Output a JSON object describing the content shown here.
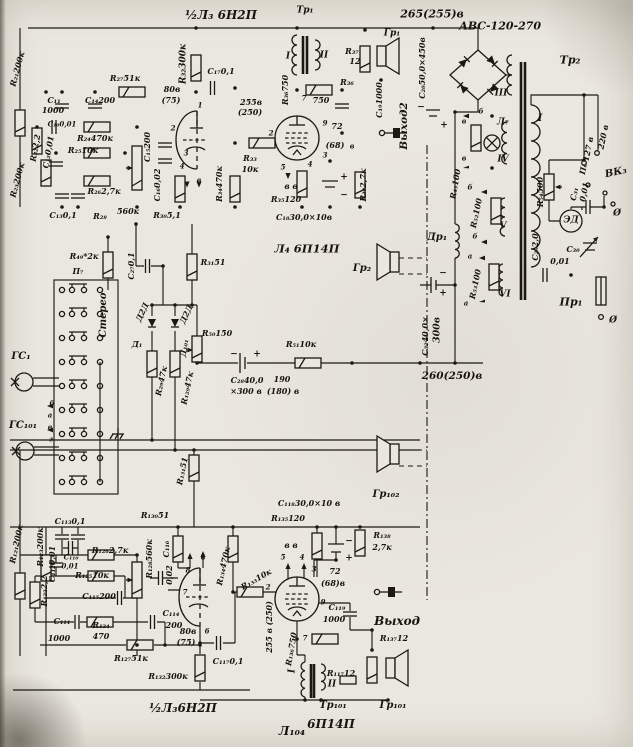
{
  "meta": {
    "description_text": "",
    "ink_color": "#1c1914",
    "paper_color": "#eae7df"
  },
  "labels": [
    {
      "n": "tube-l3-top-title",
      "t": "½Л₃ 6Н2П",
      "x": 221,
      "y": 15,
      "s": 12
    },
    {
      "n": "tr1-title",
      "t": "Тр₁",
      "x": 305,
      "y": 11,
      "s": 9
    },
    {
      "n": "rail-265v",
      "t": "265(255)в",
      "x": 432,
      "y": 14,
      "s": 11
    },
    {
      "n": "rectifier-type",
      "t": "АВС-120-270",
      "x": 500,
      "y": 26,
      "s": 11
    },
    {
      "n": "tr2-title",
      "t": "Тр₂",
      "x": 570,
      "y": 60,
      "s": 11
    },
    {
      "n": "gr1-label",
      "t": "Гр₁",
      "x": 392,
      "y": 34,
      "s": 9
    },
    {
      "n": "r37-label",
      "t": "R₃₇",
      "x": 352,
      "y": 51
    },
    {
      "n": "r37-value",
      "t": "12",
      "x": 355,
      "y": 61
    },
    {
      "n": "r36-label",
      "t": "R₃₆",
      "x": 347,
      "y": 82
    },
    {
      "n": "r36-value",
      "t": "750",
      "x": 321,
      "y": 100
    },
    {
      "n": "r36-rot",
      "t": "R₃₆750",
      "x": 285,
      "y": 90,
      "r": -90
    },
    {
      "n": "tr1-w1",
      "t": "I",
      "x": 288,
      "y": 57,
      "s": 9
    },
    {
      "n": "tr1-w2",
      "t": "II",
      "x": 324,
      "y": 56,
      "s": 9
    },
    {
      "n": "c19-label",
      "t": "C₁₉1000",
      "x": 379,
      "y": 100,
      "r": -90
    },
    {
      "n": "out2-label",
      "t": "Выход2",
      "x": 404,
      "y": 126,
      "r": -90,
      "s": 10.5
    },
    {
      "n": "c20-label",
      "t": "C₂₀50,0×450в",
      "x": 422,
      "y": 68,
      "r": -90
    },
    {
      "n": "c20-plus",
      "t": "+",
      "x": 444,
      "y": 126,
      "s": 9
    },
    {
      "n": "c20-minus",
      "t": "−",
      "x": 421,
      "y": 108,
      "s": 9
    },
    {
      "n": "v72-top",
      "t": "72",
      "x": 337,
      "y": 126
    },
    {
      "n": "v68-top",
      "t": "(68)",
      "x": 335,
      "y": 145
    },
    {
      "n": "v-b-top",
      "t": "в",
      "x": 352,
      "y": 146,
      "s": 7
    },
    {
      "n": "pin9-top",
      "t": "9",
      "x": 325,
      "y": 123,
      "s": 7
    },
    {
      "n": "r38-label",
      "t": "R₃₈2,7к",
      "x": 363,
      "y": 185,
      "r": -90
    },
    {
      "n": "r32-label",
      "t": "R₃₂300к",
      "x": 184,
      "y": 64,
      "r": -90,
      "s": 9
    },
    {
      "n": "c17-label",
      "t": "C₁₇0,1",
      "x": 221,
      "y": 71
    },
    {
      "n": "v80-top",
      "t": "80в",
      "x": 172,
      "y": 89
    },
    {
      "n": "v75-top",
      "t": "(75)",
      "x": 171,
      "y": 100
    },
    {
      "n": "v255-top",
      "t": "255в",
      "x": 251,
      "y": 102
    },
    {
      "n": "v250-top",
      "t": "(250)",
      "x": 250,
      "y": 112
    },
    {
      "n": "r33-label",
      "t": "R₃₃",
      "x": 250,
      "y": 158
    },
    {
      "n": "r33-value",
      "t": "10к",
      "x": 250,
      "y": 169
    },
    {
      "n": "r34-label",
      "t": "R₃₄470к",
      "x": 219,
      "y": 184,
      "r": -90
    },
    {
      "n": "pin7-l4",
      "t": "7",
      "x": 304,
      "y": 98,
      "s": 7
    },
    {
      "n": "pin2-l4",
      "t": "2",
      "x": 271,
      "y": 133,
      "s": 7
    },
    {
      "n": "pin5-l4",
      "t": "5",
      "x": 283,
      "y": 167,
      "s": 7
    },
    {
      "n": "pin4-l4",
      "t": "4",
      "x": 310,
      "y": 164,
      "s": 7
    },
    {
      "n": "pin3-l4",
      "t": "3",
      "x": 325,
      "y": 155,
      "s": 7
    },
    {
      "n": "vv-top",
      "t": "в в",
      "x": 291,
      "y": 186,
      "s": 8
    },
    {
      "n": "r35-label",
      "t": "R₃₅120",
      "x": 286,
      "y": 199
    },
    {
      "n": "c18-label",
      "t": "C₁₈30,0×10в",
      "x": 304,
      "y": 217
    },
    {
      "n": "c18-plus",
      "t": "+",
      "x": 344,
      "y": 178,
      "s": 9
    },
    {
      "n": "c18-minus",
      "t": "−",
      "x": 344,
      "y": 196,
      "s": 9
    },
    {
      "n": "l4-title",
      "t": "Л₄ 6П14П",
      "x": 307,
      "y": 249,
      "s": 11.5
    },
    {
      "n": "pin1-l3",
      "t": "1",
      "x": 200,
      "y": 105,
      "s": 7
    },
    {
      "n": "pin2-l3",
      "t": "2",
      "x": 173,
      "y": 128,
      "s": 7
    },
    {
      "n": "pin3-l3",
      "t": "3",
      "x": 186,
      "y": 153,
      "s": 7
    },
    {
      "n": "pin4-l3",
      "t": "4",
      "x": 182,
      "y": 166,
      "s": 7
    },
    {
      "n": "pinv-l3",
      "t": "в",
      "x": 199,
      "y": 180,
      "s": 7
    },
    {
      "n": "r27-label",
      "t": "R₂₇51к",
      "x": 125,
      "y": 78
    },
    {
      "n": "r21-label",
      "t": "R₂₁200к",
      "x": 17,
      "y": 69,
      "r": -75
    },
    {
      "n": "c11-label",
      "t": "C₁₁",
      "x": 54,
      "y": 100
    },
    {
      "n": "c11-value",
      "t": "1000",
      "x": 53,
      "y": 110
    },
    {
      "n": "c14-label",
      "t": "C₁₄200",
      "x": 100,
      "y": 100
    },
    {
      "n": "c10-label",
      "t": "C₁₀0,01",
      "x": 62,
      "y": 124,
      "s": 7
    },
    {
      "n": "r24-label",
      "t": "R₂₄470к",
      "x": 95,
      "y": 138
    },
    {
      "n": "r25-label",
      "t": "R₂₅10к",
      "x": 83,
      "y": 150
    },
    {
      "n": "r22-label",
      "t": "R₂₂2,2",
      "x": 35,
      "y": 148,
      "r": -80
    },
    {
      "n": "c12-label",
      "t": "C₁₂0,01",
      "x": 48,
      "y": 152,
      "r": -80
    },
    {
      "n": "r26-label",
      "t": "R₂₆2,7к",
      "x": 104,
      "y": 191
    },
    {
      "n": "r23-label",
      "t": "R₂₃200к",
      "x": 17,
      "y": 180,
      "r": -75
    },
    {
      "n": "c13-label",
      "t": "C₁₃0,1",
      "x": 63,
      "y": 215
    },
    {
      "n": "r28-label",
      "t": "R₂₈",
      "x": 100,
      "y": 216
    },
    {
      "n": "r28-value",
      "t": "560к",
      "x": 128,
      "y": 211
    },
    {
      "n": "r30-label",
      "t": "R₃₀5,1",
      "x": 167,
      "y": 215
    },
    {
      "n": "c15-label",
      "t": "C₁₅200",
      "x": 147,
      "y": 147,
      "r": -90
    },
    {
      "n": "c16-label",
      "t": "C₁₆0,02",
      "x": 157,
      "y": 185,
      "r": -90
    },
    {
      "n": "r49-label",
      "t": "R₄₉*2к",
      "x": 84,
      "y": 256
    },
    {
      "n": "p7-label",
      "t": "П₇",
      "x": 78,
      "y": 271
    },
    {
      "n": "stereo-label",
      "t": "Стерео",
      "x": 104,
      "y": 315,
      "r": -90,
      "s": 10
    },
    {
      "n": "c27-label",
      "t": "C₂₇0,1",
      "x": 131,
      "y": 266,
      "r": -90
    },
    {
      "n": "d2d-1",
      "t": "Д2Д",
      "x": 142,
      "y": 312,
      "r": -65
    },
    {
      "n": "d1-label",
      "t": "Д₁",
      "x": 137,
      "y": 344
    },
    {
      "n": "d2d-2",
      "t": "Д2Д",
      "x": 186,
      "y": 314,
      "r": -65
    },
    {
      "n": "d101-label",
      "t": "Д₁₀₁",
      "x": 184,
      "y": 348,
      "r": -80
    },
    {
      "n": "r31-label",
      "t": "R₃₁51",
      "x": 213,
      "y": 262
    },
    {
      "n": "r29-label",
      "t": "R₂₉47к",
      "x": 161,
      "y": 381,
      "r": -78
    },
    {
      "n": "r129-label",
      "t": "R₁₂₉47к",
      "x": 187,
      "y": 388,
      "r": -78
    },
    {
      "n": "r50-label",
      "t": "R₅₀150",
      "x": 217,
      "y": 333
    },
    {
      "n": "c28-label",
      "t": "C₂₈40,0",
      "x": 247,
      "y": 380
    },
    {
      "n": "c28-value",
      "t": "×300 в",
      "x": 246,
      "y": 391
    },
    {
      "n": "c28-minus",
      "t": "−",
      "x": 234,
      "y": 355,
      "s": 9
    },
    {
      "n": "c28-plus",
      "t": "+",
      "x": 257,
      "y": 355,
      "s": 9
    },
    {
      "n": "v190",
      "t": "190",
      "x": 282,
      "y": 379
    },
    {
      "n": "v180",
      "t": "(180) в",
      "x": 283,
      "y": 391
    },
    {
      "n": "r51-label",
      "t": "R₅₁10к",
      "x": 301,
      "y": 344
    },
    {
      "n": "gs1-label",
      "t": "ГС₁",
      "x": 21,
      "y": 357,
      "s": 10
    },
    {
      "n": "gs101-label",
      "t": "ГС₁₀₁",
      "x": 23,
      "y": 426,
      "s": 10
    },
    {
      "n": "sw-b",
      "t": "б",
      "x": 52,
      "y": 403,
      "s": 7
    },
    {
      "n": "sw-a",
      "t": "а",
      "x": 50,
      "y": 415,
      "s": 7
    },
    {
      "n": "sw-v",
      "t": "в",
      "x": 50,
      "y": 427,
      "s": 7
    },
    {
      "n": "sw-g",
      "t": "г",
      "x": 51,
      "y": 439,
      "s": 7
    },
    {
      "n": "r131-label",
      "t": "R₁₃₁51",
      "x": 182,
      "y": 471,
      "r": -78
    },
    {
      "n": "gr2-label",
      "t": "Гр₂",
      "x": 362,
      "y": 269,
      "s": 10
    },
    {
      "n": "v260",
      "t": "260(250)в",
      "x": 452,
      "y": 376,
      "s": 10.5
    },
    {
      "n": "c32-label",
      "t": "C₃₂40,0×",
      "x": 425,
      "y": 336,
      "r": -90
    },
    {
      "n": "c32-value",
      "t": "300в",
      "x": 437,
      "y": 330,
      "r": -90,
      "s": 9.5
    },
    {
      "n": "c32-minus",
      "t": "−",
      "x": 443,
      "y": 274,
      "s": 9
    },
    {
      "n": "c32-plus",
      "t": "+",
      "x": 443,
      "y": 294,
      "s": 9
    },
    {
      "n": "dr1-label",
      "t": "Др₁",
      "x": 437,
      "y": 238,
      "s": 10
    },
    {
      "n": "r45-label",
      "t": "R₄₅100",
      "x": 455,
      "y": 184,
      "r": -80
    },
    {
      "n": "l7-label",
      "t": "Л₇",
      "x": 503,
      "y": 123,
      "s": 9
    },
    {
      "n": "w4-label",
      "t": "IV",
      "x": 503,
      "y": 160,
      "s": 9
    },
    {
      "n": "w5-label",
      "t": "V",
      "x": 503,
      "y": 227,
      "s": 9
    },
    {
      "n": "w6-label",
      "t": "VI",
      "x": 505,
      "y": 295,
      "s": 9
    },
    {
      "n": "w3-label",
      "t": "III",
      "x": 501,
      "y": 94,
      "s": 9
    },
    {
      "n": "r52-label",
      "t": "R₅₂100",
      "x": 476,
      "y": 213,
      "r": -78
    },
    {
      "n": "r53-label",
      "t": "R₅₃100",
      "x": 475,
      "y": 284,
      "r": -78
    },
    {
      "n": "tap-v1",
      "t": "в",
      "x": 464,
      "y": 121,
      "s": 7
    },
    {
      "n": "tap-v2",
      "t": "в",
      "x": 464,
      "y": 158,
      "s": 7
    },
    {
      "n": "tap-b1",
      "t": "б",
      "x": 481,
      "y": 111,
      "s": 7
    },
    {
      "n": "tap-b2",
      "t": "б",
      "x": 470,
      "y": 187,
      "s": 7
    },
    {
      "n": "tap-b3",
      "t": "б",
      "x": 475,
      "y": 236,
      "s": 7
    },
    {
      "n": "tap-a1",
      "t": "а",
      "x": 470,
      "y": 256,
      "s": 7
    },
    {
      "n": "tap-a2",
      "t": "а",
      "x": 466,
      "y": 303,
      "s": 7
    },
    {
      "n": "tr2-w1",
      "t": "I",
      "x": 540,
      "y": 119,
      "s": 10
    },
    {
      "n": "r54-label",
      "t": "R₅₄500",
      "x": 540,
      "y": 192,
      "r": -90
    },
    {
      "n": "ed-label",
      "t": "ЭД",
      "x": 571,
      "y": 221,
      "s": 9
    },
    {
      "n": "c31-label",
      "t": "С₃₁",
      "x": 574,
      "y": 194,
      "r": -78
    },
    {
      "n": "c31-value",
      "t": "0,01",
      "x": 584,
      "y": 192,
      "r": -78
    },
    {
      "n": "c29-label",
      "t": "C₂₉2,0",
      "x": 535,
      "y": 247,
      "r": -90
    },
    {
      "n": "c30-label",
      "t": "С₃₀",
      "x": 573,
      "y": 249
    },
    {
      "n": "c30-value",
      "t": "0,01",
      "x": 560,
      "y": 261
    },
    {
      "n": "v127",
      "t": "127 в",
      "x": 588,
      "y": 149,
      "r": -78
    },
    {
      "n": "v220",
      "t": "220 в",
      "x": 603,
      "y": 137,
      "r": -78
    },
    {
      "n": "p6-label",
      "t": "П₆",
      "x": 583,
      "y": 169,
      "r": -78
    },
    {
      "n": "vk3-label",
      "t": "ВК₃",
      "x": 616,
      "y": 173,
      "s": 10,
      "r": -12
    },
    {
      "n": "pr1-label",
      "t": "Пр₁",
      "x": 571,
      "y": 302,
      "s": 11
    },
    {
      "n": "gnd-1",
      "t": "Ø",
      "x": 617,
      "y": 214,
      "s": 9
    },
    {
      "n": "gnd-2",
      "t": "Ø",
      "x": 613,
      "y": 321,
      "s": 9
    },
    {
      "n": "gr102-label",
      "t": "Гр₁₀₂",
      "x": 386,
      "y": 495,
      "s": 10
    },
    {
      "n": "c118-label",
      "t": "C₁₁₈30,0×10 в",
      "x": 309,
      "y": 503
    },
    {
      "n": "c118-minus",
      "t": "−",
      "x": 349,
      "y": 542,
      "s": 9
    },
    {
      "n": "c118-plus",
      "t": "+",
      "x": 349,
      "y": 559,
      "s": 9
    },
    {
      "n": "r135-label",
      "t": "R₁₃₅120",
      "x": 288,
      "y": 518
    },
    {
      "n": "r138-label",
      "t": "R₁₃₈",
      "x": 382,
      "y": 535
    },
    {
      "n": "r138-value",
      "t": "2,7к",
      "x": 382,
      "y": 547
    },
    {
      "n": "r121-label",
      "t": "R₁₂₁200к",
      "x": 16,
      "y": 544,
      "r": -78
    },
    {
      "n": "r123-label",
      "t": "R₁₂₃200к",
      "x": 40,
      "y": 547,
      "r": -90
    },
    {
      "n": "c112-label",
      "t": "C₁₁₂0,01",
      "x": 52,
      "y": 564,
      "r": -90
    },
    {
      "n": "r122-label",
      "t": "R₁₂₂2,2",
      "x": 44,
      "y": 591,
      "r": -90
    },
    {
      "n": "c113-label",
      "t": "C₁₁₃0,1",
      "x": 70,
      "y": 521
    },
    {
      "n": "c110-label",
      "t": "С₁₁₀",
      "x": 71,
      "y": 557,
      "s": 7
    },
    {
      "n": "c110-value",
      "t": "0,01",
      "x": 70,
      "y": 566,
      "s": 7
    },
    {
      "n": "r126-label",
      "t": "R₁₂₆2,7к",
      "x": 110,
      "y": 550
    },
    {
      "n": "r125-label",
      "t": "R₁₂₅10к",
      "x": 92,
      "y": 575
    },
    {
      "n": "c115-label",
      "t": "С₁₁₅200",
      "x": 99,
      "y": 596
    },
    {
      "n": "c111-label",
      "t": "C₁₁₁",
      "x": 62,
      "y": 621
    },
    {
      "n": "c111-value",
      "t": "1000",
      "x": 59,
      "y": 638
    },
    {
      "n": "r124-label",
      "t": "R₁₂₄",
      "x": 101,
      "y": 625
    },
    {
      "n": "r124-value",
      "t": "470",
      "x": 101,
      "y": 636
    },
    {
      "n": "r127-label",
      "t": "R₁₂₇51к",
      "x": 131,
      "y": 658
    },
    {
      "n": "r128-label",
      "t": "R₁₂₈560к",
      "x": 149,
      "y": 559,
      "r": -90
    },
    {
      "n": "r130-label",
      "t": "R₁₃₀51",
      "x": 155,
      "y": 515
    },
    {
      "n": "c116-label",
      "t": "C₁₁₆",
      "x": 166,
      "y": 549,
      "r": -90
    },
    {
      "n": "c116-value",
      "t": "0,02",
      "x": 169,
      "y": 575,
      "r": -90
    },
    {
      "n": "c114-label",
      "t": "C₁₁₄",
      "x": 171,
      "y": 613
    },
    {
      "n": "c114-value",
      "t": "200",
      "x": 174,
      "y": 625
    },
    {
      "n": "v80-bot",
      "t": "80в",
      "x": 188,
      "y": 631
    },
    {
      "n": "v75-bot",
      "t": "(75)",
      "x": 186,
      "y": 642
    },
    {
      "n": "r132-label",
      "t": "R₁₃₂300к",
      "x": 168,
      "y": 676
    },
    {
      "n": "c117-label",
      "t": "C₁₁₇0,1",
      "x": 228,
      "y": 661
    },
    {
      "n": "tube-l3-bot-title",
      "t": "½Л₃6Н2П",
      "x": 183,
      "y": 708,
      "s": 12
    },
    {
      "n": "r134-label",
      "t": "R₁₃₄470к",
      "x": 223,
      "y": 566,
      "r": -78
    },
    {
      "n": "r133-label",
      "t": "R₁₃₃10к",
      "x": 256,
      "y": 579,
      "r": -30
    },
    {
      "n": "v255-bot",
      "t": "255 в (250)",
      "x": 269,
      "y": 627,
      "r": -90
    },
    {
      "n": "vv-bot",
      "t": "в в",
      "x": 291,
      "y": 545,
      "s": 8
    },
    {
      "n": "pin5-l104",
      "t": "5",
      "x": 283,
      "y": 557,
      "s": 7
    },
    {
      "n": "pin4-l104",
      "t": "4",
      "x": 302,
      "y": 557,
      "s": 7
    },
    {
      "n": "pin3-l104",
      "t": "3",
      "x": 314,
      "y": 569,
      "s": 7
    },
    {
      "n": "v72-bot",
      "t": "72",
      "x": 335,
      "y": 571
    },
    {
      "n": "v68-bot",
      "t": "(68)в",
      "x": 333,
      "y": 583
    },
    {
      "n": "pin2-l104",
      "t": "2",
      "x": 268,
      "y": 587,
      "s": 7
    },
    {
      "n": "pin9-l104",
      "t": "9",
      "x": 323,
      "y": 602,
      "s": 7
    },
    {
      "n": "pin7-l104",
      "t": "7",
      "x": 305,
      "y": 638,
      "s": 7
    },
    {
      "n": "c119-label",
      "t": "C₁₁₉",
      "x": 337,
      "y": 607
    },
    {
      "n": "c119-value",
      "t": "1000",
      "x": 334,
      "y": 619
    },
    {
      "n": "r136-label",
      "t": "R₁₃₆750",
      "x": 291,
      "y": 649,
      "r": -80
    },
    {
      "n": "tr101-w1",
      "t": "I",
      "x": 293,
      "y": 671,
      "r": -90,
      "s": 9
    },
    {
      "n": "out-label",
      "t": "Выход",
      "x": 397,
      "y": 621,
      "s": 12
    },
    {
      "n": "r137-label",
      "t": "R₁₃₇12",
      "x": 394,
      "y": 638
    },
    {
      "n": "r117-label",
      "t": "R₁₁₇12",
      "x": 341,
      "y": 673
    },
    {
      "n": "tr101-w2",
      "t": "II",
      "x": 332,
      "y": 685,
      "s": 9
    },
    {
      "n": "tr101-title",
      "t": "Тр₁₀₁",
      "x": 333,
      "y": 706,
      "s": 10
    },
    {
      "n": "gr101-label",
      "t": "Гр₁₀₁",
      "x": 393,
      "y": 706,
      "s": 10
    },
    {
      "n": "l104-title",
      "t": "Л₁₀₄",
      "x": 292,
      "y": 731,
      "s": 12
    },
    {
      "n": "l104-type",
      "t": "6П14П",
      "x": 331,
      "y": 724,
      "s": 12
    },
    {
      "n": "pinv-l3b",
      "t": "в",
      "x": 203,
      "y": 557,
      "s": 7
    },
    {
      "n": "pin8-l3b",
      "t": "8",
      "x": 188,
      "y": 570,
      "s": 7
    },
    {
      "n": "pin7-l3b",
      "t": "7",
      "x": 185,
      "y": 592,
      "s": 7
    },
    {
      "n": "pin6-l3b",
      "t": "6",
      "x": 207,
      "y": 631,
      "s": 7
    }
  ]
}
